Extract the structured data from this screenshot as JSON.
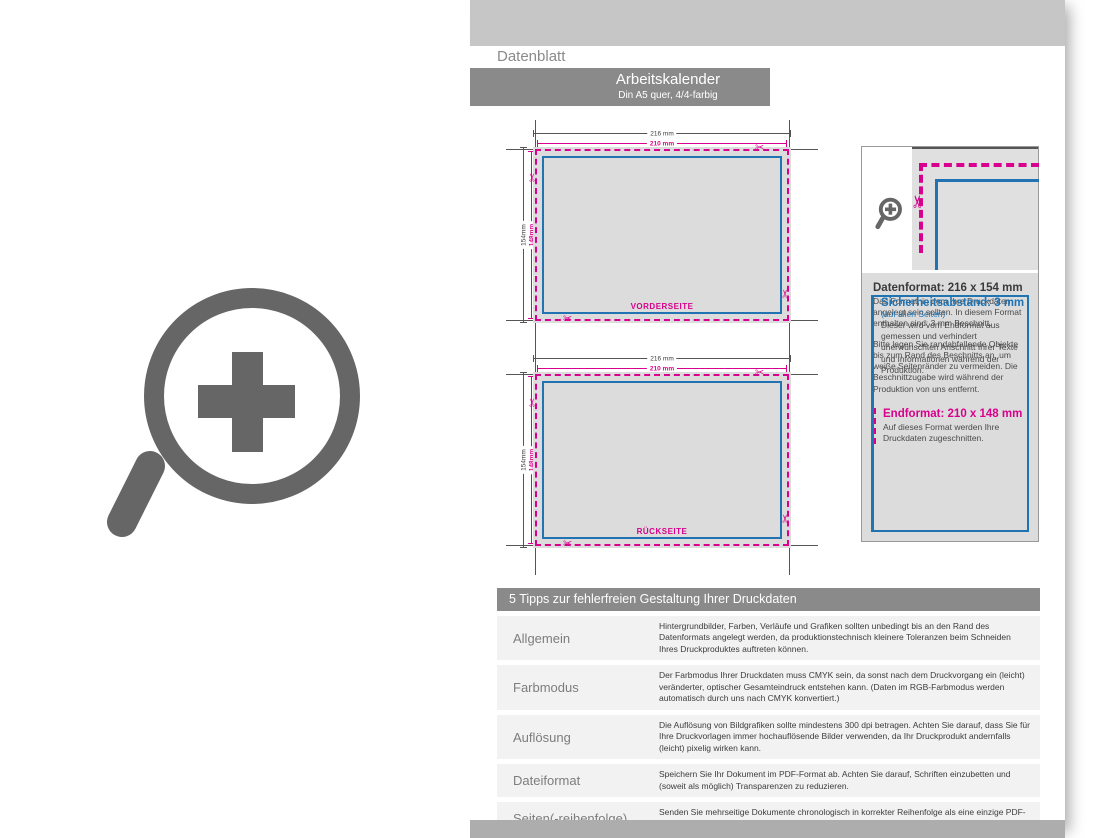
{
  "colors": {
    "magenta": "#d8008c",
    "blue": "#2173b2",
    "bar_gray": "#8a8a8a",
    "artboard_gray": "#dcdcdc"
  },
  "page": {
    "tab_label": "Datenblatt",
    "title": "Arbeitskalender",
    "subtitle": "Din A5 quer, 4/4-farbig"
  },
  "diagrams": [
    {
      "label": "VORDERSEITE",
      "outer_width": "216 mm",
      "inner_width": "210 mm",
      "outer_height": "154mm",
      "inner_height": "148mm"
    },
    {
      "label": "RÜCKSEITE",
      "outer_width": "216 mm",
      "inner_width": "210 mm",
      "outer_height": "154mm",
      "inner_height": "148mm"
    }
  ],
  "info_box": {
    "datenformat": {
      "heading": "Datenformat: 216 x 154 mm",
      "p1": "Das Format, in dem Ihre Druckdaten angelegt sein sollten. In diesem Format enthalten sind: 3 mm Beschnitt.",
      "p2": "Bitte legen Sie randabfallende Objekte bis zum Rand des Beschnitts an, um weiße Seitenränder zu vermeiden. Die Beschnitt­zugabe wird während der Produktion von uns entfernt."
    },
    "endformat": {
      "heading": "Endformat: 210 x 148 mm",
      "body": "Auf dieses Format werden Ihre Druckdaten zugeschnitten."
    },
    "sicherheitsabstand": {
      "heading": "Sicherheitsabstand: 3 mm",
      "subheading": "(auf allen Seiten)",
      "body": "Dieser wird vom Endformat aus gemessen und verhindert unerwünschten Anschnitt Ihrer Texte und Informationen während der Produktion."
    }
  },
  "tips": {
    "header": "5 Tipps zur fehlerfreien Gestaltung Ihrer Druckdaten",
    "rows": [
      {
        "label": "Allgemein",
        "text": "Hintergrundbilder, Farben, Verläufe und Grafiken sollten unbedingt bis an den Rand des Datenformats angelegt werden, da produktionstechnisch kleinere Toleranzen beim Schneiden Ihres Druckproduktes auftreten können."
      },
      {
        "label": "Farbmodus",
        "text": "Der Farbmodus Ihrer Druckdaten muss CMYK sein, da sonst nach dem Druckvorgang ein (leicht) veränderter, optischer Gesamteindruck entstehen kann. (Daten im RGB-Farbmodus werden automatisch durch uns nach CMYK konvertiert.)"
      },
      {
        "label": "Auflösung",
        "text": "Die Auflösung von Bildgrafiken sollte mindestens 300 dpi betragen. Achten Sie darauf, dass Sie für Ihre Druckvorlagen immer hochauflösende Bilder verwenden, da Ihr Druckprodukt andernfalls (leicht) pixelig wirken kann."
      },
      {
        "label": "Dateiformat",
        "text": "Speichern Sie Ihr Dokument im PDF-Format ab. Achten Sie darauf, Schriften einzubetten und (soweit als möglich) Transparenzen zu reduzieren."
      },
      {
        "label": "Seiten(-reihenfolge)",
        "text": "Senden Sie mehrseitige Dokumente chronologisch in korrekter Reihenfolge als eine einzige PDF-Datei oder benennen Sie Einzeldokumente entsprechend mit fortlaufenden Seitennummern."
      }
    ]
  },
  "icons": {
    "big_zoom": "zoom-plus-icon",
    "small_zoom": "zoom-plus-icon",
    "scissors": "scissors-icon"
  }
}
